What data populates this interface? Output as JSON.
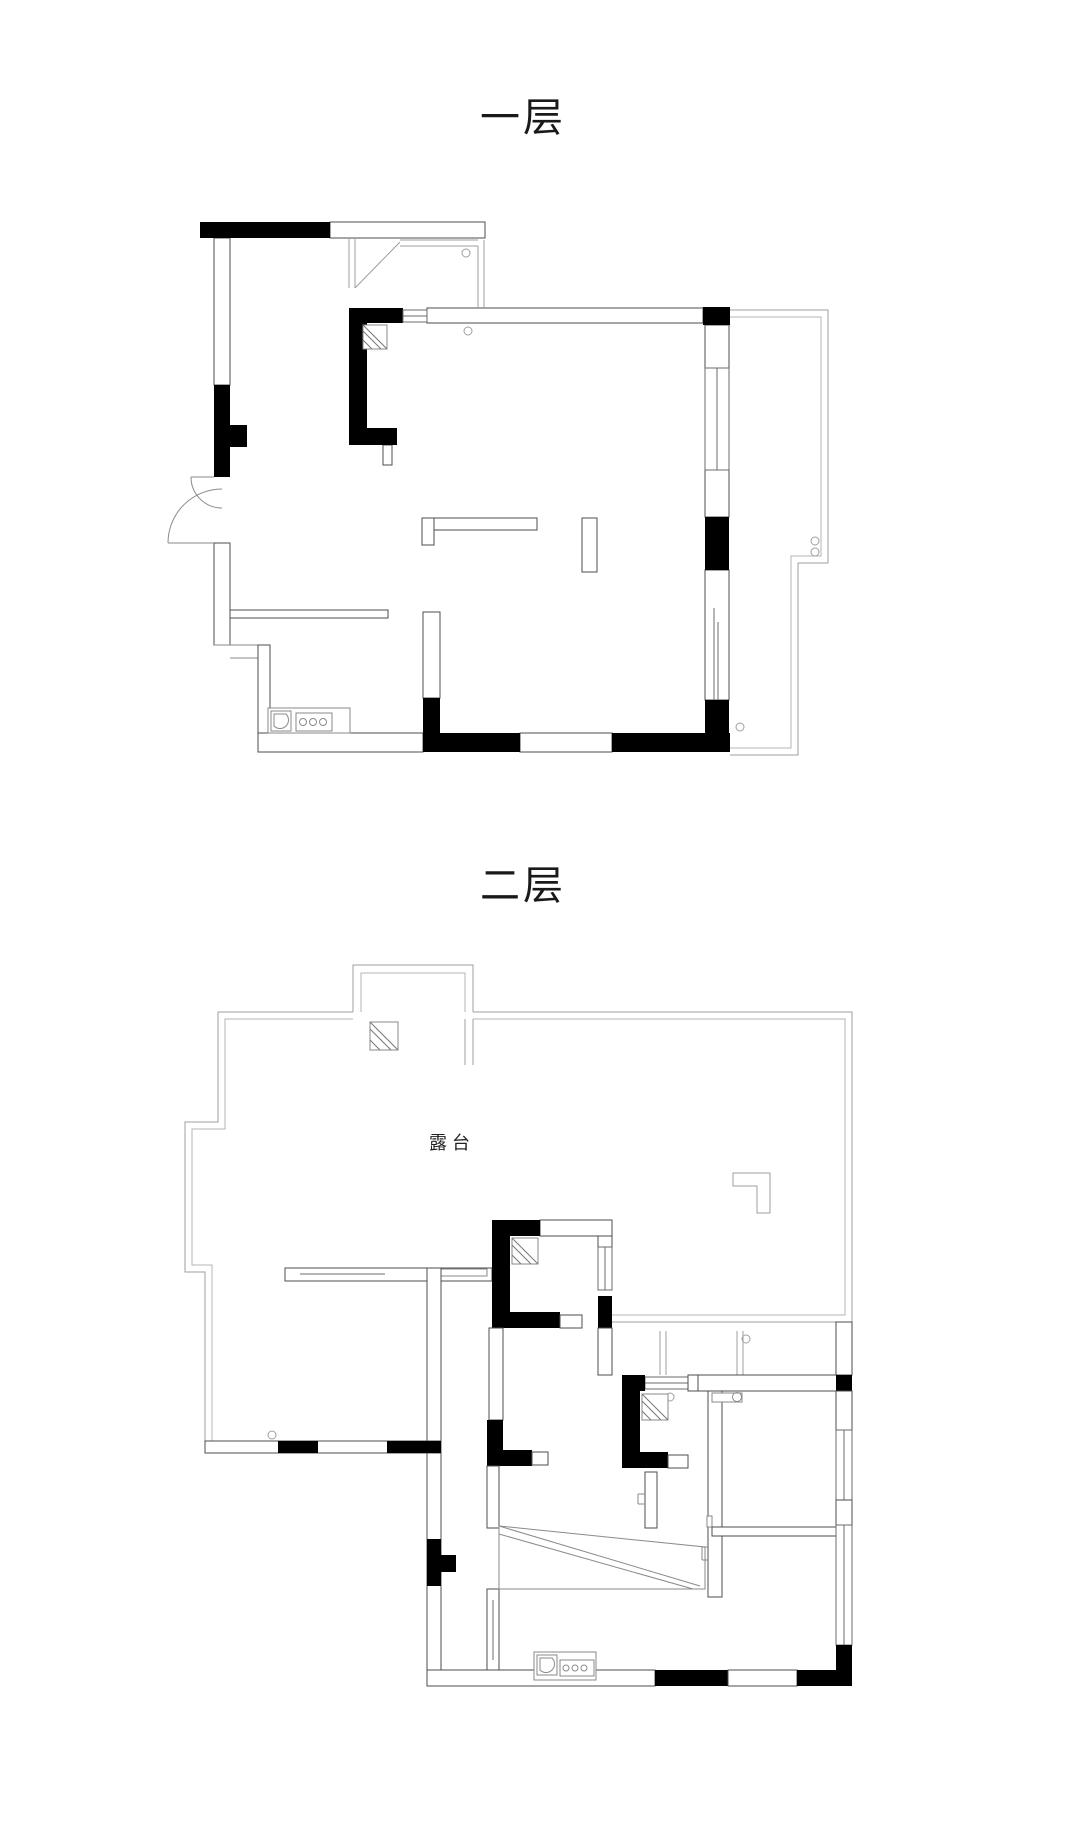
{
  "document": {
    "type": "floor-plan-drawing",
    "background": "#ffffff"
  },
  "floors": {
    "first": {
      "title": "一层"
    },
    "second": {
      "title": "二层",
      "terrace_label": "露台"
    }
  },
  "colors": {
    "wall_fill": "#000000",
    "wall_outline": "#4d4d4d",
    "railing_line": "#9f9f9f",
    "window_line": "#6b6b6b",
    "text": "#1a1a1a"
  },
  "icons": {
    "entry_door": "double-swing-door-arc",
    "kitchen": "sink-and-three-burners",
    "flue": "square-with-hatched-corner",
    "stairs": "wedge-with-diagonals",
    "pipes": "small-circles"
  }
}
